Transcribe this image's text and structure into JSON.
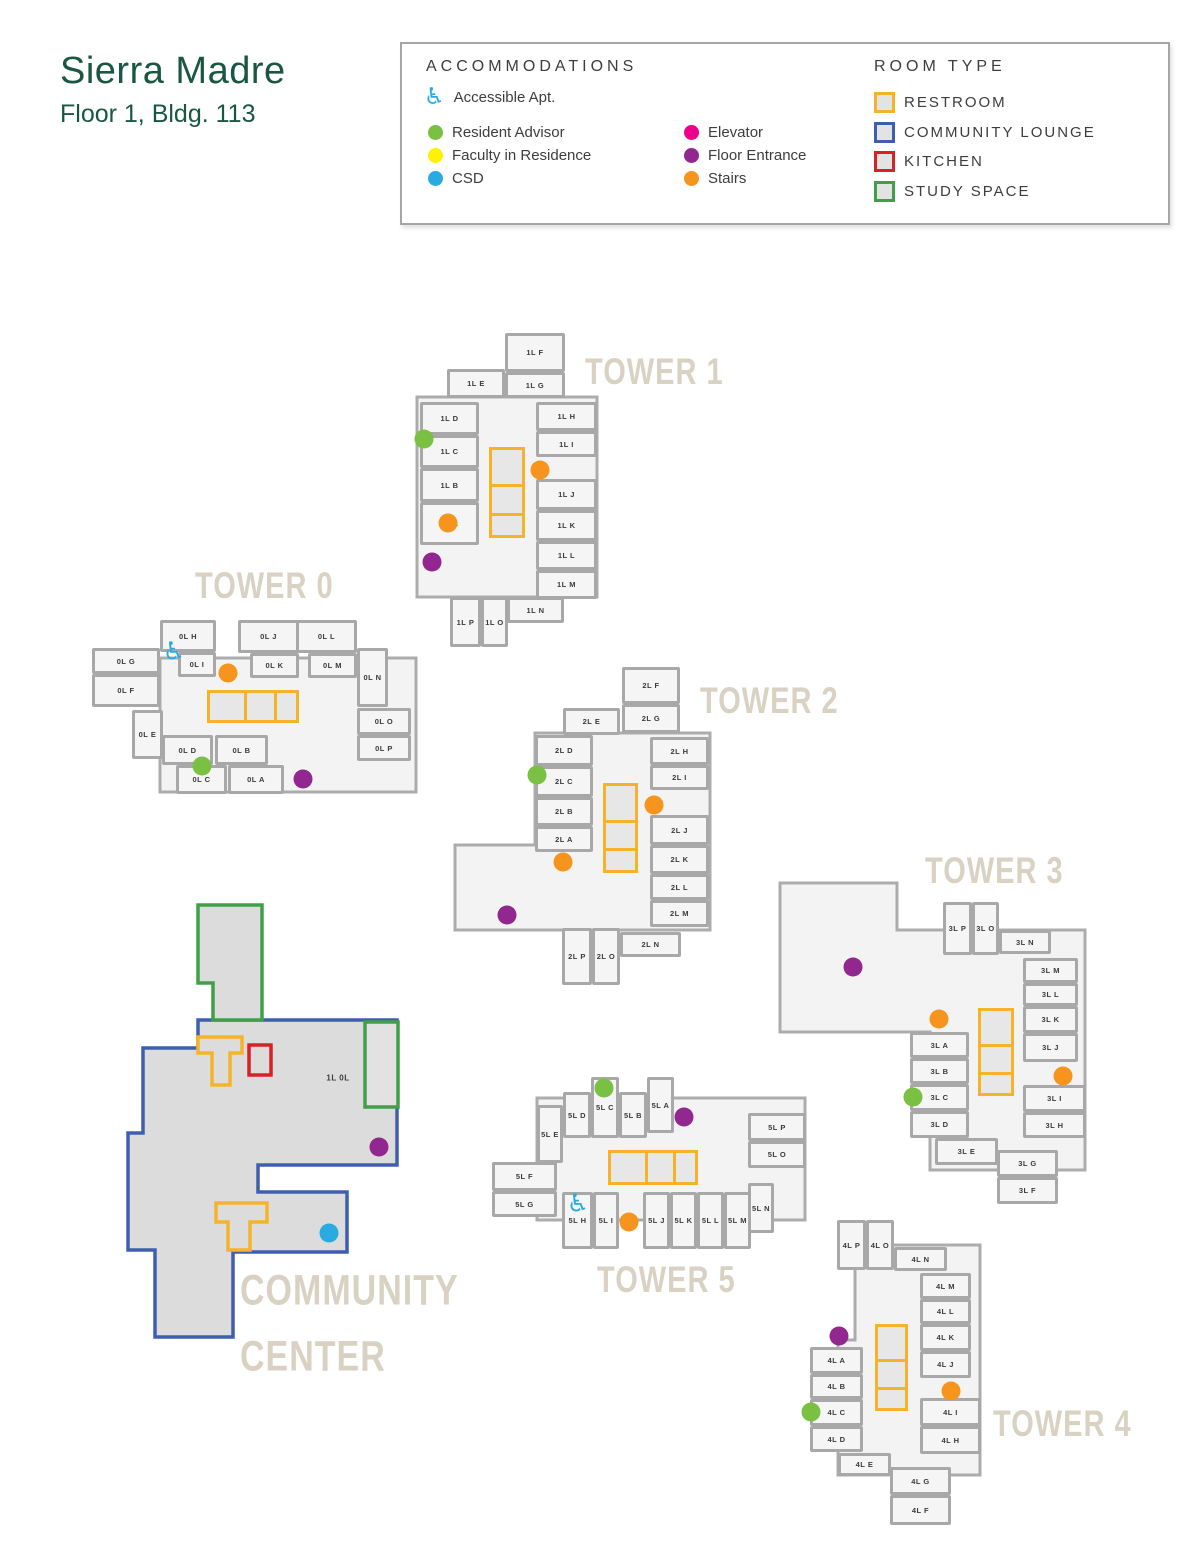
{
  "title": {
    "name": "Sierra Madre",
    "subtitle": "Floor 1, Bldg. 113"
  },
  "legend": {
    "accommodations": {
      "heading": "ACCOMMODATIONS",
      "items": [
        {
          "key": "accessible",
          "label": "Accessible Apt.",
          "color": "#29abe2",
          "icon": "wheelchair"
        },
        {
          "key": "resident_advisor",
          "label": "Resident Advisor",
          "color": "#7ac143"
        },
        {
          "key": "faculty",
          "label": "Faculty in Residence",
          "color": "#fff200"
        },
        {
          "key": "csd",
          "label": "CSD",
          "color": "#29abe2"
        },
        {
          "key": "elevator",
          "label": "Elevator",
          "color": "#ec008c"
        },
        {
          "key": "floor_entrance",
          "label": "Floor Entrance",
          "color": "#92278f"
        },
        {
          "key": "stairs",
          "label": "Stairs",
          "color": "#f7941d"
        }
      ]
    },
    "room_type": {
      "heading": "ROOM TYPE",
      "items": [
        {
          "label": "RESTROOM",
          "color": "#f5b32b"
        },
        {
          "label": "COMMUNITY LOUNGE",
          "color": "#3f5fae"
        },
        {
          "label": "KITCHEN",
          "color": "#d92027"
        },
        {
          "label": "STUDY SPACE",
          "color": "#3fa047"
        }
      ]
    }
  },
  "map": {
    "marker_colors": {
      "resident_advisor": "#7ac143",
      "faculty": "#fff200",
      "csd": "#29abe2",
      "elevator": "#ec008c",
      "floor_entrance": "#92278f",
      "stairs": "#f7941d",
      "accessible": "#29abe2"
    },
    "towers": [
      {
        "id": "tower-1",
        "label": "TOWER 1",
        "lx": 585,
        "ly": 352,
        "rooms": [
          {
            "l": "1L F",
            "x": 505,
            "y": 333,
            "w": 60,
            "h": 39
          },
          {
            "l": "1L G",
            "x": 505,
            "y": 372,
            "w": 60,
            "h": 26
          },
          {
            "l": "1L E",
            "x": 447,
            "y": 369,
            "w": 58,
            "h": 29
          },
          {
            "l": "1L D",
            "x": 420,
            "y": 402,
            "w": 59,
            "h": 33
          },
          {
            "l": "1L C",
            "x": 420,
            "y": 435,
            "w": 59,
            "h": 33
          },
          {
            "l": "1L B",
            "x": 420,
            "y": 468,
            "w": 59,
            "h": 34
          },
          {
            "l": "1L A",
            "x": 420,
            "y": 502,
            "w": 59,
            "h": 43
          },
          {
            "l": "1L H",
            "x": 536,
            "y": 402,
            "w": 61,
            "h": 29
          },
          {
            "l": "1L I",
            "x": 536,
            "y": 431,
            "w": 61,
            "h": 26
          },
          {
            "l": "1L J",
            "x": 536,
            "y": 479,
            "w": 61,
            "h": 31
          },
          {
            "l": "1L K",
            "x": 536,
            "y": 510,
            "w": 61,
            "h": 31
          },
          {
            "l": "1L L",
            "x": 536,
            "y": 541,
            "w": 61,
            "h": 29
          },
          {
            "l": "1L M",
            "x": 536,
            "y": 570,
            "w": 61,
            "h": 29
          },
          {
            "l": "1L N",
            "x": 507,
            "y": 597,
            "w": 57,
            "h": 26
          },
          {
            "l": "1L P",
            "x": 450,
            "y": 597,
            "w": 31,
            "h": 50
          },
          {
            "l": "1L O",
            "x": 481,
            "y": 597,
            "w": 27,
            "h": 50
          }
        ],
        "restroom": {
          "x": 489,
          "y": 447,
          "w": 36,
          "h": 91,
          "o": "v"
        },
        "markers": [
          {
            "t": "resident_advisor",
            "x": 424,
            "y": 439
          },
          {
            "t": "stairs",
            "x": 540,
            "y": 470
          },
          {
            "t": "stairs",
            "x": 448,
            "y": 523
          },
          {
            "t": "floor_entrance",
            "x": 432,
            "y": 562
          }
        ]
      },
      {
        "id": "tower-0",
        "label": "TOWER 0",
        "lx": 195,
        "ly": 566,
        "rooms": [
          {
            "l": "0L H",
            "x": 160,
            "y": 620,
            "w": 56,
            "h": 32
          },
          {
            "l": "0L I",
            "x": 178,
            "y": 652,
            "w": 38,
            "h": 25
          },
          {
            "l": "0L G",
            "x": 92,
            "y": 648,
            "w": 68,
            "h": 26
          },
          {
            "l": "0L F",
            "x": 92,
            "y": 674,
            "w": 68,
            "h": 33
          },
          {
            "l": "0L J",
            "x": 238,
            "y": 620,
            "w": 61,
            "h": 33
          },
          {
            "l": "0L K",
            "x": 250,
            "y": 653,
            "w": 49,
            "h": 25
          },
          {
            "l": "0L L",
            "x": 296,
            "y": 620,
            "w": 61,
            "h": 33
          },
          {
            "l": "0L M",
            "x": 308,
            "y": 653,
            "w": 49,
            "h": 25
          },
          {
            "l": "0L N",
            "x": 357,
            "y": 648,
            "w": 31,
            "h": 59
          },
          {
            "l": "0L O",
            "x": 357,
            "y": 708,
            "w": 54,
            "h": 27
          },
          {
            "l": "0L P",
            "x": 357,
            "y": 735,
            "w": 54,
            "h": 26
          },
          {
            "l": "0L E",
            "x": 132,
            "y": 710,
            "w": 31,
            "h": 49
          },
          {
            "l": "0L D",
            "x": 162,
            "y": 735,
            "w": 51,
            "h": 30
          },
          {
            "l": "0L C",
            "x": 176,
            "y": 765,
            "w": 51,
            "h": 29
          },
          {
            "l": "0L B",
            "x": 215,
            "y": 735,
            "w": 53,
            "h": 30
          },
          {
            "l": "0L A",
            "x": 228,
            "y": 765,
            "w": 56,
            "h": 29
          }
        ],
        "restroom": {
          "x": 207,
          "y": 690,
          "w": 92,
          "h": 33,
          "o": "h"
        },
        "markers": [
          {
            "t": "accessible",
            "x": 174,
            "y": 651
          },
          {
            "t": "stairs",
            "x": 228,
            "y": 673
          },
          {
            "t": "resident_advisor",
            "x": 202,
            "y": 766
          },
          {
            "t": "floor_entrance",
            "x": 303,
            "y": 779
          }
        ]
      },
      {
        "id": "tower-2",
        "label": "TOWER 2",
        "lx": 700,
        "ly": 681,
        "rooms": [
          {
            "l": "2L F",
            "x": 622,
            "y": 667,
            "w": 58,
            "h": 37
          },
          {
            "l": "2L G",
            "x": 622,
            "y": 704,
            "w": 58,
            "h": 29
          },
          {
            "l": "2L E",
            "x": 563,
            "y": 708,
            "w": 57,
            "h": 27
          },
          {
            "l": "2L D",
            "x": 535,
            "y": 735,
            "w": 58,
            "h": 31
          },
          {
            "l": "2L C",
            "x": 535,
            "y": 766,
            "w": 58,
            "h": 31
          },
          {
            "l": "2L B",
            "x": 535,
            "y": 797,
            "w": 58,
            "h": 29
          },
          {
            "l": "2L A",
            "x": 535,
            "y": 826,
            "w": 58,
            "h": 26
          },
          {
            "l": "2L H",
            "x": 650,
            "y": 737,
            "w": 59,
            "h": 28
          },
          {
            "l": "2L I",
            "x": 650,
            "y": 765,
            "w": 59,
            "h": 25
          },
          {
            "l": "2L J",
            "x": 650,
            "y": 815,
            "w": 59,
            "h": 30
          },
          {
            "l": "2L K",
            "x": 650,
            "y": 845,
            "w": 59,
            "h": 29
          },
          {
            "l": "2L L",
            "x": 650,
            "y": 874,
            "w": 59,
            "h": 26
          },
          {
            "l": "2L M",
            "x": 650,
            "y": 900,
            "w": 59,
            "h": 27
          },
          {
            "l": "2L N",
            "x": 620,
            "y": 932,
            "w": 61,
            "h": 25
          },
          {
            "l": "2L P",
            "x": 562,
            "y": 928,
            "w": 30,
            "h": 57
          },
          {
            "l": "2L O",
            "x": 592,
            "y": 928,
            "w": 28,
            "h": 57
          }
        ],
        "restroom": {
          "x": 603,
          "y": 783,
          "w": 35,
          "h": 90,
          "o": "v"
        },
        "markers": [
          {
            "t": "resident_advisor",
            "x": 537,
            "y": 775
          },
          {
            "t": "stairs",
            "x": 654,
            "y": 805
          },
          {
            "t": "stairs",
            "x": 563,
            "y": 862
          },
          {
            "t": "floor_entrance",
            "x": 507,
            "y": 915
          }
        ]
      },
      {
        "id": "tower-3",
        "label": "TOWER 3",
        "lx": 925,
        "ly": 851,
        "rooms": [
          {
            "l": "3L P",
            "x": 943,
            "y": 902,
            "w": 29,
            "h": 53
          },
          {
            "l": "3L O",
            "x": 972,
            "y": 902,
            "w": 27,
            "h": 53
          },
          {
            "l": "3L N",
            "x": 999,
            "y": 930,
            "w": 52,
            "h": 24
          },
          {
            "l": "3L M",
            "x": 1023,
            "y": 958,
            "w": 55,
            "h": 25
          },
          {
            "l": "3L L",
            "x": 1023,
            "y": 983,
            "w": 55,
            "h": 23
          },
          {
            "l": "3L K",
            "x": 1023,
            "y": 1006,
            "w": 55,
            "h": 27
          },
          {
            "l": "3L J",
            "x": 1023,
            "y": 1033,
            "w": 55,
            "h": 29
          },
          {
            "l": "3L A",
            "x": 910,
            "y": 1032,
            "w": 59,
            "h": 26
          },
          {
            "l": "3L B",
            "x": 910,
            "y": 1058,
            "w": 59,
            "h": 26
          },
          {
            "l": "3L C",
            "x": 910,
            "y": 1084,
            "w": 59,
            "h": 27
          },
          {
            "l": "3L D",
            "x": 910,
            "y": 1111,
            "w": 59,
            "h": 27
          },
          {
            "l": "3L E",
            "x": 935,
            "y": 1138,
            "w": 63,
            "h": 27
          },
          {
            "l": "3L I",
            "x": 1023,
            "y": 1085,
            "w": 63,
            "h": 27
          },
          {
            "l": "3L H",
            "x": 1023,
            "y": 1112,
            "w": 63,
            "h": 26
          },
          {
            "l": "3L G",
            "x": 997,
            "y": 1150,
            "w": 61,
            "h": 27
          },
          {
            "l": "3L F",
            "x": 997,
            "y": 1177,
            "w": 61,
            "h": 27
          }
        ],
        "restroom": {
          "x": 978,
          "y": 1008,
          "w": 36,
          "h": 88,
          "o": "v"
        },
        "markers": [
          {
            "t": "floor_entrance",
            "x": 853,
            "y": 967
          },
          {
            "t": "stairs",
            "x": 939,
            "y": 1019
          },
          {
            "t": "resident_advisor",
            "x": 913,
            "y": 1097
          },
          {
            "t": "stairs",
            "x": 1063,
            "y": 1076
          }
        ]
      },
      {
        "id": "tower-5",
        "label": "TOWER 5",
        "lx": 597,
        "ly": 1260,
        "rooms": [
          {
            "l": "5L D",
            "x": 563,
            "y": 1092,
            "w": 28,
            "h": 46
          },
          {
            "l": "5L C",
            "x": 591,
            "y": 1077,
            "w": 28,
            "h": 61
          },
          {
            "l": "5L B",
            "x": 619,
            "y": 1092,
            "w": 28,
            "h": 46
          },
          {
            "l": "5L A",
            "x": 647,
            "y": 1077,
            "w": 27,
            "h": 56
          },
          {
            "l": "5L E",
            "x": 537,
            "y": 1105,
            "w": 26,
            "h": 58
          },
          {
            "l": "5L P",
            "x": 748,
            "y": 1113,
            "w": 58,
            "h": 28
          },
          {
            "l": "5L O",
            "x": 748,
            "y": 1141,
            "w": 58,
            "h": 27
          },
          {
            "l": "5L F",
            "x": 492,
            "y": 1162,
            "w": 65,
            "h": 29
          },
          {
            "l": "5L G",
            "x": 492,
            "y": 1191,
            "w": 65,
            "h": 26
          },
          {
            "l": "5L N",
            "x": 748,
            "y": 1183,
            "w": 26,
            "h": 50
          },
          {
            "l": "5L H",
            "x": 562,
            "y": 1192,
            "w": 31,
            "h": 57
          },
          {
            "l": "5L I",
            "x": 593,
            "y": 1192,
            "w": 26,
            "h": 57
          },
          {
            "l": "5L J",
            "x": 643,
            "y": 1192,
            "w": 27,
            "h": 57
          },
          {
            "l": "5L K",
            "x": 670,
            "y": 1192,
            "w": 27,
            "h": 57
          },
          {
            "l": "5L L",
            "x": 697,
            "y": 1192,
            "w": 27,
            "h": 57
          },
          {
            "l": "5L M",
            "x": 724,
            "y": 1192,
            "w": 27,
            "h": 57
          }
        ],
        "restroom": {
          "x": 608,
          "y": 1150,
          "w": 90,
          "h": 35,
          "o": "h"
        },
        "markers": [
          {
            "t": "resident_advisor",
            "x": 604,
            "y": 1088
          },
          {
            "t": "floor_entrance",
            "x": 684,
            "y": 1117
          },
          {
            "t": "accessible",
            "x": 578,
            "y": 1203
          },
          {
            "t": "stairs",
            "x": 629,
            "y": 1222
          }
        ]
      },
      {
        "id": "tower-4",
        "label": "TOWER 4",
        "lx": 993,
        "ly": 1404,
        "rooms": [
          {
            "l": "4L P",
            "x": 837,
            "y": 1220,
            "w": 29,
            "h": 50
          },
          {
            "l": "4L O",
            "x": 866,
            "y": 1220,
            "w": 28,
            "h": 50
          },
          {
            "l": "4L N",
            "x": 894,
            "y": 1247,
            "w": 53,
            "h": 24
          },
          {
            "l": "4L M",
            "x": 920,
            "y": 1273,
            "w": 51,
            "h": 26
          },
          {
            "l": "4L L",
            "x": 920,
            "y": 1299,
            "w": 51,
            "h": 25
          },
          {
            "l": "4L K",
            "x": 920,
            "y": 1324,
            "w": 51,
            "h": 27
          },
          {
            "l": "4L J",
            "x": 920,
            "y": 1351,
            "w": 51,
            "h": 27
          },
          {
            "l": "4L A",
            "x": 810,
            "y": 1347,
            "w": 53,
            "h": 27
          },
          {
            "l": "4L B",
            "x": 810,
            "y": 1374,
            "w": 53,
            "h": 25
          },
          {
            "l": "4L C",
            "x": 810,
            "y": 1399,
            "w": 53,
            "h": 27
          },
          {
            "l": "4L D",
            "x": 810,
            "y": 1426,
            "w": 53,
            "h": 26
          },
          {
            "l": "4L I",
            "x": 920,
            "y": 1398,
            "w": 61,
            "h": 28
          },
          {
            "l": "4L H",
            "x": 920,
            "y": 1426,
            "w": 61,
            "h": 28
          },
          {
            "l": "4L E",
            "x": 838,
            "y": 1453,
            "w": 53,
            "h": 23
          },
          {
            "l": "4L G",
            "x": 890,
            "y": 1467,
            "w": 61,
            "h": 28
          },
          {
            "l": "4L F",
            "x": 890,
            "y": 1495,
            "w": 61,
            "h": 30
          }
        ],
        "restroom": {
          "x": 875,
          "y": 1324,
          "w": 33,
          "h": 87,
          "o": "v"
        },
        "markers": [
          {
            "t": "floor_entrance",
            "x": 839,
            "y": 1336
          },
          {
            "t": "resident_advisor",
            "x": 811,
            "y": 1412
          },
          {
            "t": "stairs",
            "x": 951,
            "y": 1391
          }
        ]
      }
    ],
    "community": {
      "label_lines": [
        "COMMUNITY",
        "CENTER"
      ],
      "lx": 240,
      "ly": 1258,
      "room_label": {
        "text": "1L 0L",
        "x": 338,
        "y": 1078
      },
      "markers": [
        {
          "t": "floor_entrance",
          "x": 379,
          "y": 1147
        },
        {
          "t": "csd",
          "x": 329,
          "y": 1233
        }
      ]
    }
  }
}
